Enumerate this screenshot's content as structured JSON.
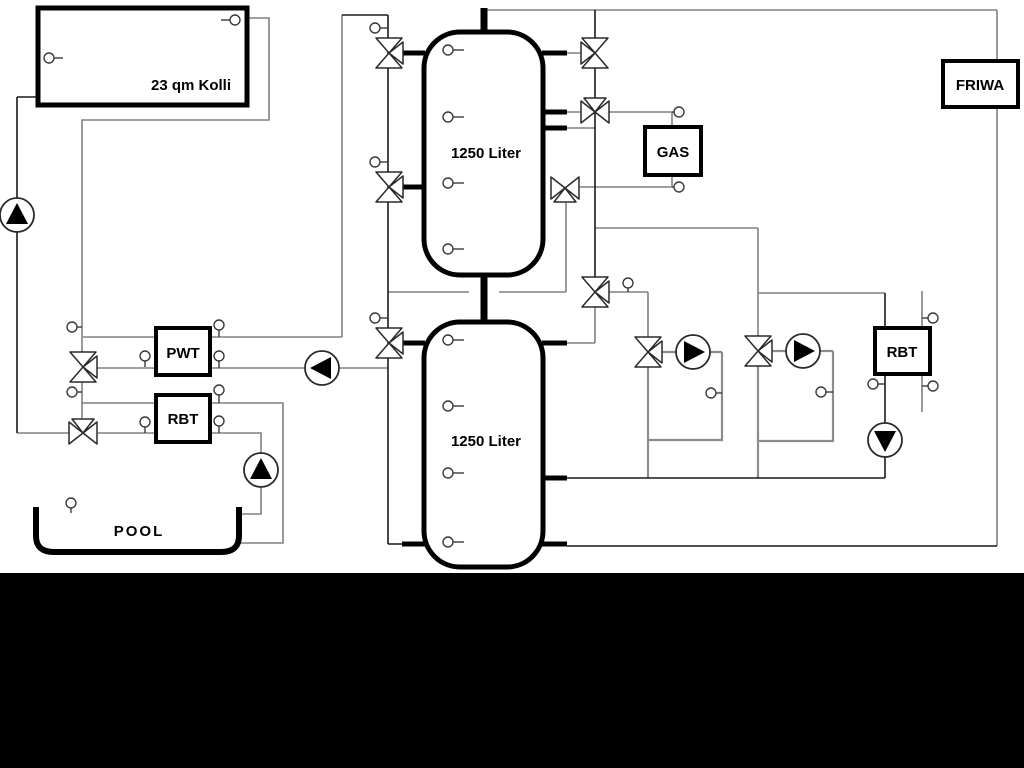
{
  "diagram": {
    "type": "hydraulic-heating-schematic",
    "labels": {
      "collector": "23 qm Kolli",
      "tank_top": "1250 Liter",
      "tank_bottom": "1250 Liter",
      "gas": "GAS",
      "friwa": "FRIWA",
      "pwt": "PWT",
      "rbt_left": "RBT",
      "rbt_right": "RBT",
      "pool": "POOL"
    },
    "colors": {
      "background": "#ffffff",
      "footer_band": "#000000",
      "pipe_secondary": "#808080",
      "pipe_primary": "#1a1a1a",
      "component_outline": "#000000"
    }
  }
}
